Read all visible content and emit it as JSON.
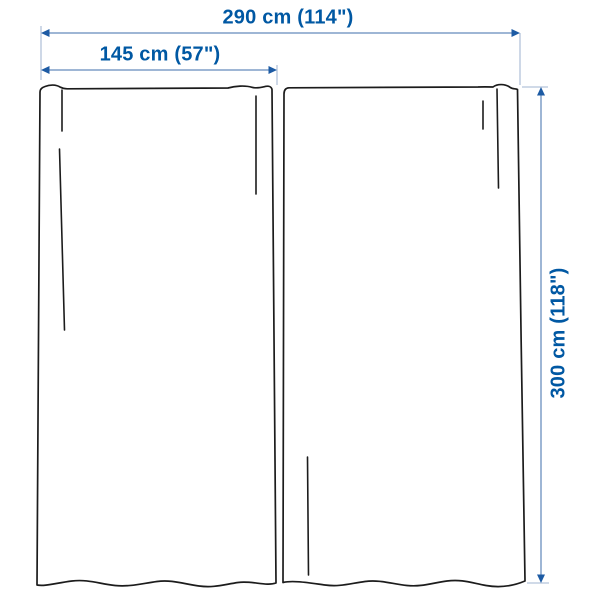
{
  "diagram": {
    "type": "product-dimension-diagram",
    "subject": "curtain-pair-two-panels",
    "labels": {
      "total_width": "290 cm (114\")",
      "panel_width": "145 cm (57\")",
      "panel_height": "300 cm (118\")"
    },
    "colors": {
      "background": "#ffffff",
      "label_text": "#0058a3",
      "dimension_line": "#7e9dc7",
      "extension_line": "#b4c4da",
      "arrowhead": "#1d5ba4",
      "panel_outline": "#1c1c1c"
    }
  }
}
